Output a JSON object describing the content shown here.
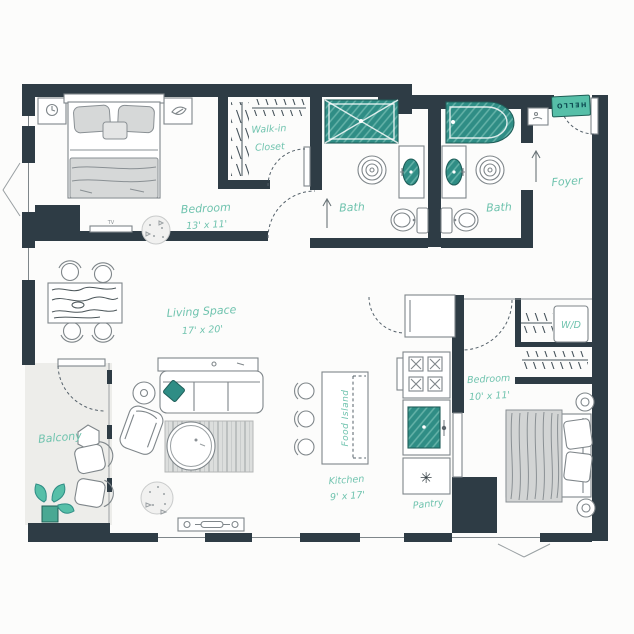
{
  "colors": {
    "wall": "#2e3c45",
    "label_teal": "#6fc3ae",
    "fixture_teal": "#2f8d85",
    "mat_teal": "#56bfa8",
    "balcony_floor": "#ededea",
    "furniture_stroke": "#7f868a",
    "light_gray": "#d6d8d8",
    "background": "#fcfcfb"
  },
  "labels": {
    "bedroom1": {
      "name": "Bedroom",
      "dims": "13' x 11'"
    },
    "walkin_closet": {
      "line1": "Walk-in",
      "line2": "Closet"
    },
    "bath1": {
      "name": "Bath"
    },
    "bath2": {
      "name": "Bath"
    },
    "foyer": {
      "name": "Foyer"
    },
    "living": {
      "name": "Living Space",
      "dims": "17' x 20'"
    },
    "balcony": {
      "name": "Balcony"
    },
    "kitchen": {
      "name": "Kitchen",
      "dims": "9' x 17'"
    },
    "food_island": {
      "name": "Food Island"
    },
    "pantry": {
      "name": "Pantry"
    },
    "bedroom2": {
      "name": "Bedroom",
      "dims": "10' x 11'"
    },
    "washer_dryer": {
      "name": "W/D"
    },
    "doormat": {
      "name": "HELLO"
    },
    "tv": {
      "name": "TV"
    }
  },
  "icons": {
    "pantry_star": "✳"
  }
}
